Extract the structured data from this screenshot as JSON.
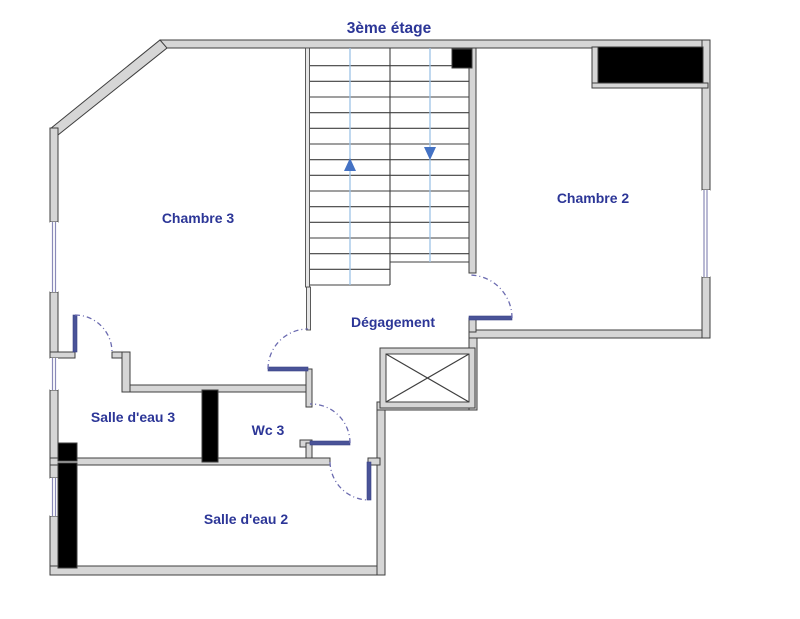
{
  "title": "3ème étage",
  "rooms": {
    "chambre3": "Chambre 3",
    "chambre2": "Chambre 2",
    "degagement": "Dégagement",
    "salle_eau_3": "Salle d'eau 3",
    "wc3": "Wc 3",
    "salle_eau_2": "Salle d'eau 2"
  },
  "stairs": {
    "up_arrow_icon": "stair-flight-up",
    "down_arrow_icon": "stair-flight-down"
  },
  "colors": {
    "label_text": "#2c3697",
    "wall_fill": "#d6d6d6",
    "wall_outline": "#3f3f3f",
    "door_leaf": "#4a5398",
    "door_swing_arc": "#6b6bb0",
    "stair_guide_line": "#9dc3e6",
    "direction_arrow": "#4472c4",
    "solid_elements": "#000000",
    "window_line": "#8a8ab8"
  }
}
